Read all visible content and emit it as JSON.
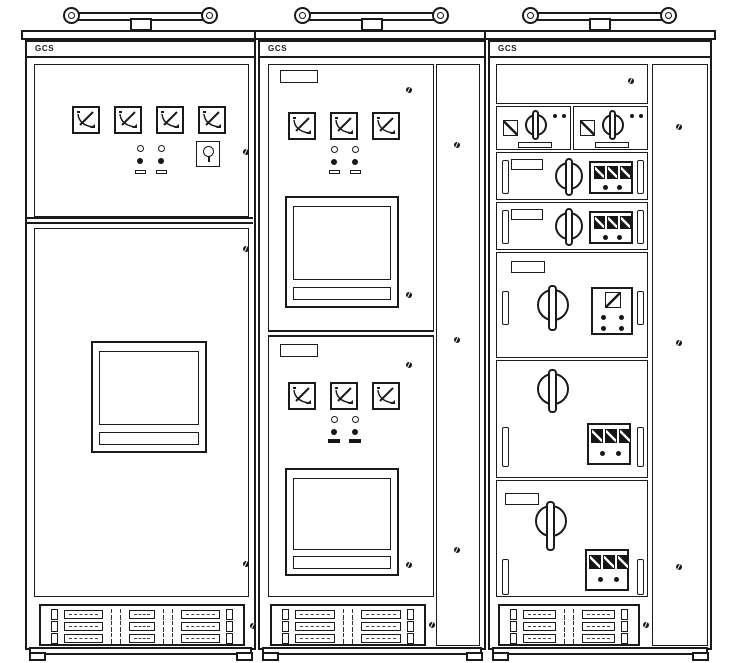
{
  "title": "Front elevation drawing of three GCS low-voltage switchgear cabinets",
  "colors": {
    "line": "#1a1a1a",
    "panel": "#ffffff",
    "dark_fill": "#161616"
  },
  "cabinets": [
    {
      "brand_label": "GCS",
      "analog_meters": 4,
      "indicator_lamps": 4,
      "key_switches": 1,
      "display_windows": 1,
      "terminal_rows": 3
    },
    {
      "brand_label": "GCS",
      "analog_meters": 6,
      "indicator_lamps": 8,
      "display_windows": 2,
      "nameplates": 2,
      "terminal_rows": 3
    },
    {
      "brand_label": "GCS",
      "drawer_units": 7,
      "rotary_switches": 7,
      "meter_blocks": 5,
      "nameplates": 4,
      "terminal_rows": 3
    }
  ]
}
